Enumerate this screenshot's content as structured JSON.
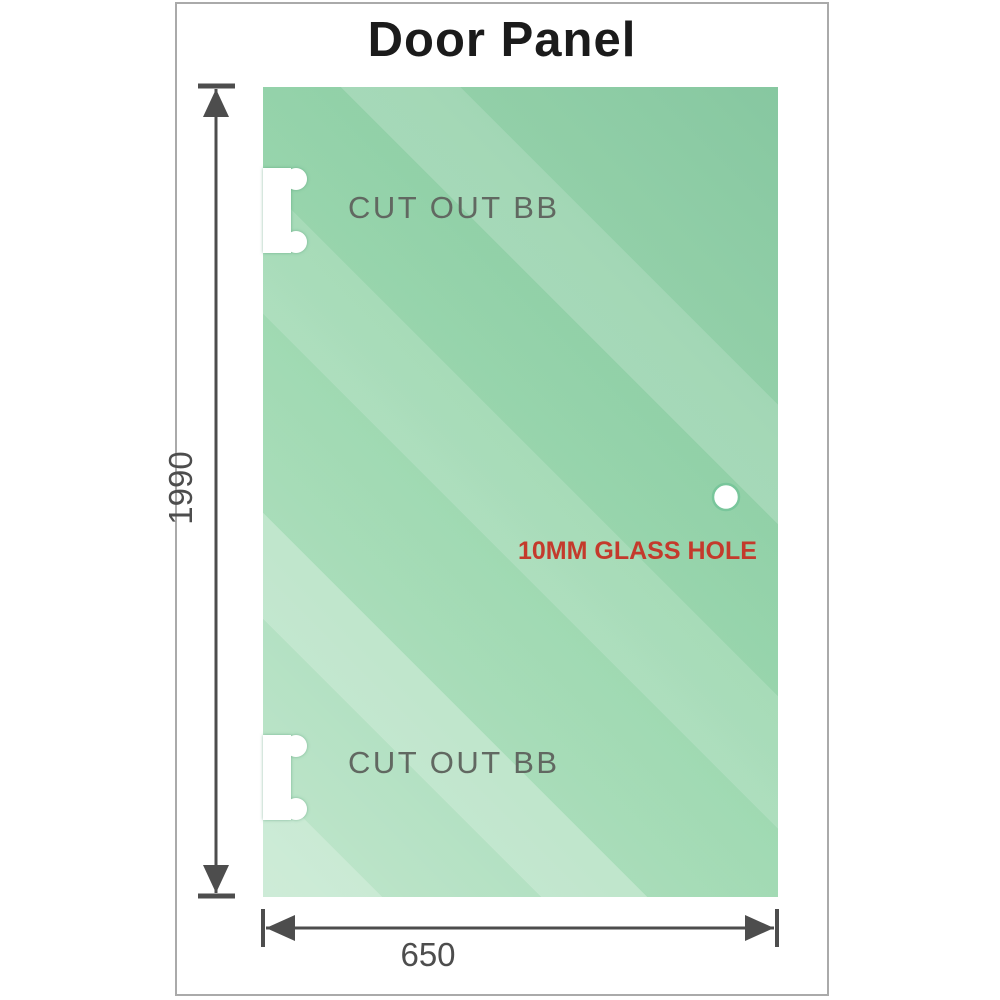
{
  "title": "Door Panel",
  "panel": {
    "cutouts": [
      {
        "label": "CUT OUT BB"
      },
      {
        "label": "CUT OUT BB"
      }
    ],
    "glass_hole": {
      "label": "10MM GLASS HOLE"
    }
  },
  "dimensions": {
    "height": {
      "value": "1990"
    },
    "width": {
      "value": "650"
    }
  },
  "colors": {
    "glass-green": "#9ad7ae",
    "frame-gray": "#aaaaaa",
    "title-black": "#1b1b1b",
    "dim-gray": "#4d4d4d",
    "cutout-label-gray": "#616861",
    "hole-label-red": "#c43a2c",
    "cutout-ring-green": "#79c69b"
  }
}
